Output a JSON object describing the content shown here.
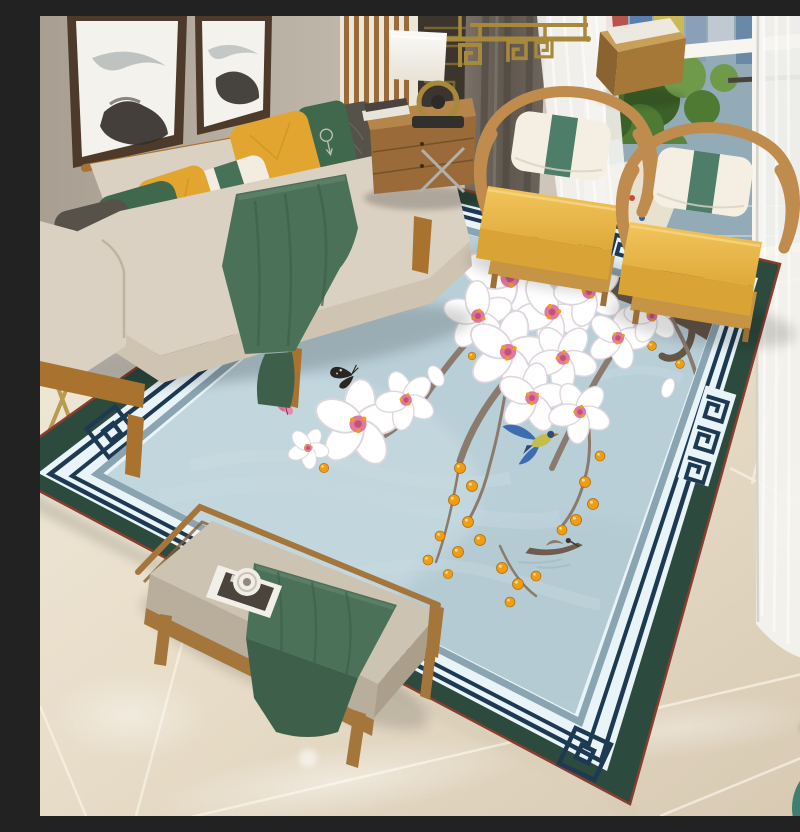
{
  "scene": {
    "type": "interior-photo",
    "title": "New Chinese style living room with magnolia-and-bird area rug, beige sofa, yellow hoop armchairs and glossy marble floor",
    "wall_art": "two ink-wash mountain landscape paintings in dark wood frames",
    "window_view": [
      "city buildings",
      "green park trees",
      "lake with small boats",
      "light shore path"
    ],
    "curtains": [
      "dark gray blackout panel",
      "white sheer panels"
    ],
    "rug": {
      "style": "Chinese magnolia branch rug",
      "field": "light blue with faint mountain texture",
      "border": [
        "dark green outer band",
        "thin maroon edge",
        "ivory band with double navy pinstripes",
        "navy Greek-key meander segments",
        "slate blue inner frame"
      ],
      "motifs": [
        "white magnolia blossoms",
        "gnarled branch",
        "orange berries",
        "perched blue bird",
        "flying blue-and-yellow bird",
        "black butterfly",
        "pink butterfly",
        "small fishing boat"
      ]
    },
    "furniture": [
      {
        "name": "sofa",
        "upholstery": "beige",
        "frame": "warm walnut wood",
        "pillows": [
          "dark gray quilted",
          "deep green with white motif",
          "mustard yellow",
          "cream with green band",
          "mustard yellow",
          "deep green with white motif",
          "dark gray"
        ],
        "throw": "deep green"
      },
      {
        "name": "armchair-left",
        "seat": "mustard yellow",
        "frame": "curved wood hoop",
        "pillow": "cream with green stripe"
      },
      {
        "name": "armchair-right",
        "seat": "mustard yellow",
        "frame": "curved wood hoop",
        "pillow": "cream with green stripe"
      },
      {
        "name": "bench",
        "cushion": "taupe",
        "throw": "deep green",
        "props": [
          "magazine",
          "round glass cup"
        ]
      },
      {
        "name": "side-cabinet",
        "props": [
          "white table lamp",
          "books",
          "dark teapot"
        ]
      },
      {
        "name": "wood-cube-stool"
      },
      {
        "name": "gold-side-table"
      },
      {
        "name": "ceramic-drum-stool"
      },
      {
        "name": "teal-ottoman"
      },
      {
        "name": "gold-fretwork-chandelier"
      }
    ],
    "colors": {
      "wall": "#b3aa9e",
      "wallLight": "#cfc8bc",
      "frameWood": "#4e3a2b",
      "canvas": "#f4f2ec",
      "ink": "#34302b",
      "slatWood": "#9a6a38",
      "slatBg": "#ebe6da",
      "fretPanel": "#3b352d",
      "fretGold": "#8a7030",
      "chandGold": "#a8893c",
      "winFrame": "#f7f5f0",
      "viewWater": "#93abb6",
      "viewTree": "#4e7a33",
      "viewTreeLight": "#6f9a4a",
      "viewShore": "#e7e1ce",
      "curtain": "#6b6259",
      "curtainFold": "#4f4840",
      "sheer": "#f4f3ef",
      "floorUpper": "#ddd5c4",
      "grout": "#f8f2e4",
      "tileGray": "#c8c2ba",
      "rugOuter": "#2c4a3e",
      "rugRed": "#8a3c2e",
      "rugLight": "#e9f4f9",
      "rugNavy": "#1e3a52",
      "rugFrame": "#8ba4b1",
      "rugField": "#b9cfd8",
      "rugFieldLight": "#cfdfe5",
      "branch": "#8b7a6e",
      "branchDark": "#655648",
      "petal": "#ffffff",
      "petalShade": "#ddd6dd",
      "flowerPink": "#e0799c",
      "berry": "#ef9d15",
      "berryDark": "#b06c0a",
      "birdBlue": "#3d6cb0",
      "birdBlueDark": "#2e4a7a",
      "birdYellow": "#c3bd4e",
      "bfBlack": "#2c2621",
      "bfPink": "#e06896",
      "boat": "#6e5c4e",
      "boatLight": "#8d7a6c",
      "sofaWood": "#a9732f",
      "sofaBeige": "#dbd1c2",
      "sofaBeigeDark": "#cfc3b2",
      "sofaShade": "#bdb09c",
      "pGray": "#56524a",
      "pGreen": "#3f684d",
      "pYellow": "#e2a52f",
      "pWhite": "#f2ede0",
      "pBand": "#47725a",
      "throw": "#4b7158",
      "throwDark": "#3e604a",
      "throwLight": "#5d8168",
      "cabinetWood": "#9a6a38",
      "lampShade": "#f6f4ee",
      "lampBase": "#32302c",
      "chairWood": "#c08c4e",
      "chairWoodDark": "#9c6d35",
      "chairYellow": "#ecb84a",
      "chairYellowDark": "#d9a335",
      "chairBase": "#c59445",
      "chairPillow": "#f4efe2",
      "chairBand": "#4e7d6a",
      "benchWood": "#a5763c",
      "benchCushion": "#cdc3b3",
      "benchCushionDark": "#b9ae9c",
      "benchFace": "#ab9f8c",
      "magazine": "#f2efe8",
      "magCover": "#4a443c",
      "goldTable": "#b89a50",
      "darkCab": "#5a3a28",
      "stoolWhite": "#edebe5",
      "stoolDark": "#3a3a38",
      "tealStool": "#3f7e71"
    }
  }
}
